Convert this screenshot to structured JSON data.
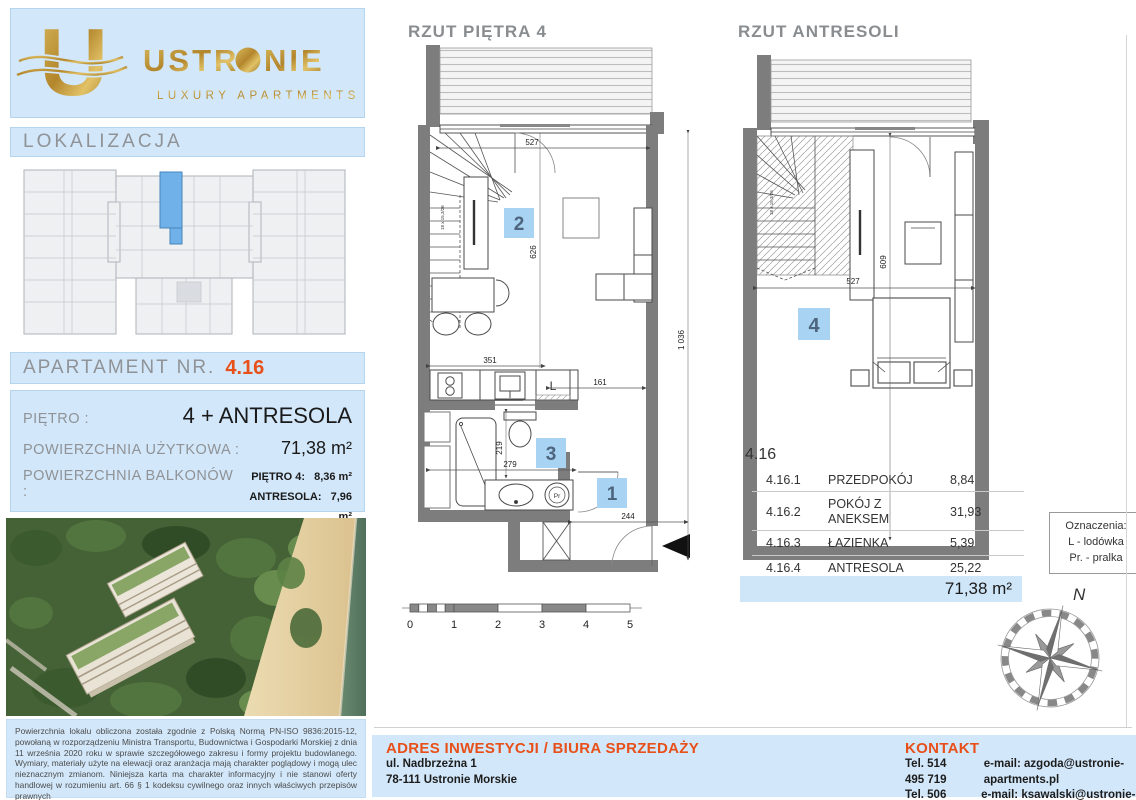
{
  "brand": {
    "name": "USTRONIE",
    "name_pre": "USTR",
    "name_post": "NIE",
    "tagline": "LUXURY APARTMENTS",
    "logo_letter": "U"
  },
  "sidebar": {
    "lokalizacja_label": "LOKALIZACJA",
    "apartment_label": "APARTAMENT NR.",
    "apartment_number": "4.16",
    "floor_label": "PIĘTRO :",
    "floor_value": "4 + ANTRESOLA",
    "usable_area_label": "POWIERZCHNIA UŻYTKOWA :",
    "usable_area_value": "71,38 m²",
    "balcony_label": "POWIERZCHNIA BALKONÓW :",
    "balcony_floor_label": "PIĘTRO 4:",
    "balcony_floor_value": "8,36 m²",
    "balcony_mezz_label": "ANTRESOLA:",
    "balcony_mezz_value": "7,96 m²",
    "legal_text": "Powierzchnia lokalu obliczona została zgodnie z Polską Normą PN-ISO 9836:2015-12, powołaną w rozporządzeniu Ministra Transportu, Budownictwa i Gospodarki Morskiej z dnia 11 września 2020 roku w sprawie szczegółowego zakresu i formy projektu budowlanego. Wymiary, materiały użyte na elewacji oraz aranżacja mają charakter poglądowy i mogą ulec nieznacznym zmianom. Niniejsza karta ma charakter informacyjny i nie stanowi oferty handlowej w rozumieniu art. 66 § 1 kodeksu cywilnego oraz innych właściwych przepisów prawnych"
  },
  "plans": {
    "floor4": {
      "title": "RZUT PIĘTRA 4",
      "badge1": "1",
      "badge2": "2",
      "badge3": "3",
      "fridge_label": "L",
      "washer_label": "Pr",
      "stair_note": "18 x 15,3/26",
      "dims": {
        "top": "527",
        "room_height": "626",
        "kitchen": "351",
        "fridge_gap": "161",
        "unit_height": "1 036",
        "bath_height": "219",
        "bath_width": "279",
        "hall": "244"
      }
    },
    "mezzanine": {
      "title": "RZUT ANTRESOLI",
      "badge4": "4",
      "stair_note": "18 x 15,3/26",
      "dims": {
        "width": "527",
        "height": "609"
      }
    }
  },
  "scalebar": {
    "labels": [
      "0",
      "1",
      "2",
      "3",
      "4",
      "5"
    ]
  },
  "table": {
    "unit": "4.16",
    "rows": [
      {
        "id": "4.16.1",
        "name": "PRZEDPOKÓJ",
        "area": "8,84"
      },
      {
        "id": "4.16.2",
        "name": "POKÓJ Z ANEKSEM",
        "area": "31,93"
      },
      {
        "id": "4.16.3",
        "name": "ŁAZIENKA",
        "area": "5,39"
      },
      {
        "id": "4.16.4",
        "name": "ANTRESOLA",
        "area": "25,22"
      }
    ],
    "total": "71,38 m²"
  },
  "legend": {
    "title": "Oznaczenia:",
    "line1": "L - lodówka",
    "line2": "Pr. - pralka"
  },
  "compass": {
    "north": "N"
  },
  "footer": {
    "address_title": "ADRES INWESTYCJI / BIURA SPRZEDAŻY",
    "address_line1": "ul. Nadbrzeżna 1",
    "address_line2": "78-111 Ustronie Morskie",
    "contact_title": "KONTAKT",
    "phone1": "Tel. 514 495 719",
    "phone2": "Tel. 506 128 263",
    "email1": "e-mail: azgoda@ustronie-apartments.pl",
    "email2": "e-mail: ksawalski@ustronie-apartments.pl"
  },
  "colors": {
    "accent_orange": "#e8501a",
    "panel_blue": "#d2e7f9",
    "badge_blue": "#a9d3f2",
    "total_row_blue": "#cfe5f8",
    "highlight_unit_blue": "#6fb1e8",
    "gold": "#c3973c"
  }
}
